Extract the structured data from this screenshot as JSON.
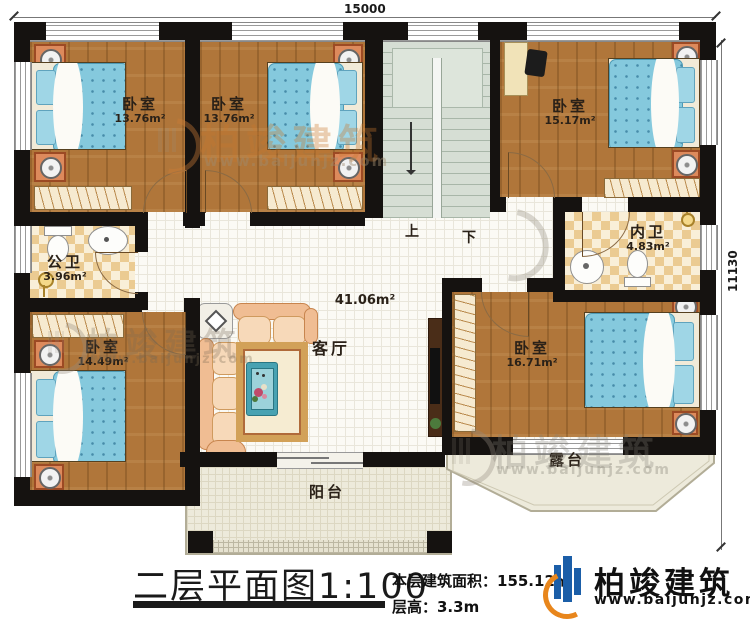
{
  "dimensions": {
    "top": "15000",
    "right": "11130"
  },
  "stairs": {
    "up": "上",
    "down": "下"
  },
  "rooms": {
    "bedroom_top_left": {
      "label": "卧室",
      "area": "13.76m²"
    },
    "bedroom_top_middle": {
      "label": "卧室",
      "area": "13.76m²"
    },
    "bedroom_top_right": {
      "label": "卧室",
      "area": "15.17m²"
    },
    "public_bathroom": {
      "label": "公卫",
      "area": "3.96m²"
    },
    "inner_bathroom": {
      "label": "内卫",
      "area": "4.83m²"
    },
    "bedroom_bottom_left": {
      "label": "卧室",
      "area": "14.49m²"
    },
    "bedroom_bottom_right": {
      "label": "卧室",
      "area": "16.71m²"
    },
    "living_room": {
      "label": "客厅",
      "area": "41.06m²"
    },
    "balcony": {
      "label": "阳台"
    },
    "terrace": {
      "label": "露台"
    }
  },
  "title_block": {
    "title": "二层平面图1:100",
    "building_area": "本层建筑面积：155.12㎡",
    "floor_height": "层高：3.3m"
  },
  "logo": {
    "brand": "柏竣建筑",
    "website": "www.baijunjz.com"
  },
  "watermark": {
    "brand": "柏竣建筑",
    "website": "www.baijunjz.com"
  },
  "colors": {
    "wall": "#151210",
    "wood": "#b0763a",
    "mattress": "#85c9dd",
    "bath_tile": "#ebcb92",
    "stair": "#d6ded4",
    "balcony": "#edeadb",
    "accent_blue": "#1b5ea8",
    "accent_orange": "#e8861c"
  }
}
